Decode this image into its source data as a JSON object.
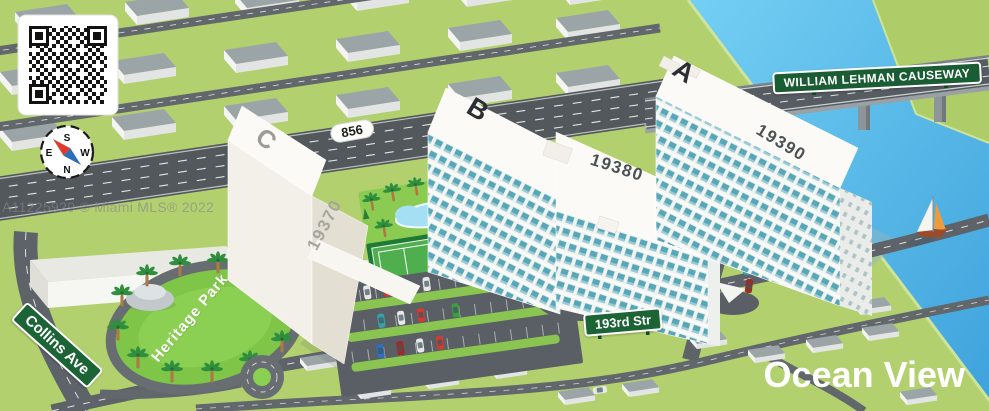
{
  "page": {
    "watermark": "A11225929 © Miami MLS® 2022",
    "logo": "Ocean View"
  },
  "signs": {
    "causeway": "WILLIAM LEHMAN CAUSEWAY",
    "route_856": "856",
    "collins_ave": "Collins Ave",
    "street_193rd": "193rd Str",
    "heritage_park": "Heritage Park"
  },
  "buildings": [
    {
      "letter": "A",
      "number": "19390"
    },
    {
      "letter": "B",
      "number": "19380"
    },
    {
      "letter": "C",
      "number": "19370"
    }
  ],
  "compass": {
    "north": "N",
    "south": "S",
    "east": "E",
    "west": "W"
  },
  "colors": {
    "grass": "#b3d06e",
    "park_green": "#7fc548",
    "water_light": "#74cff3",
    "water_deep": "#3fa3dc",
    "road_gray": "#5d6368",
    "sign_green": "#1c6336",
    "window_teal": "#58a7b8",
    "building_white": "#fbfaf6"
  }
}
